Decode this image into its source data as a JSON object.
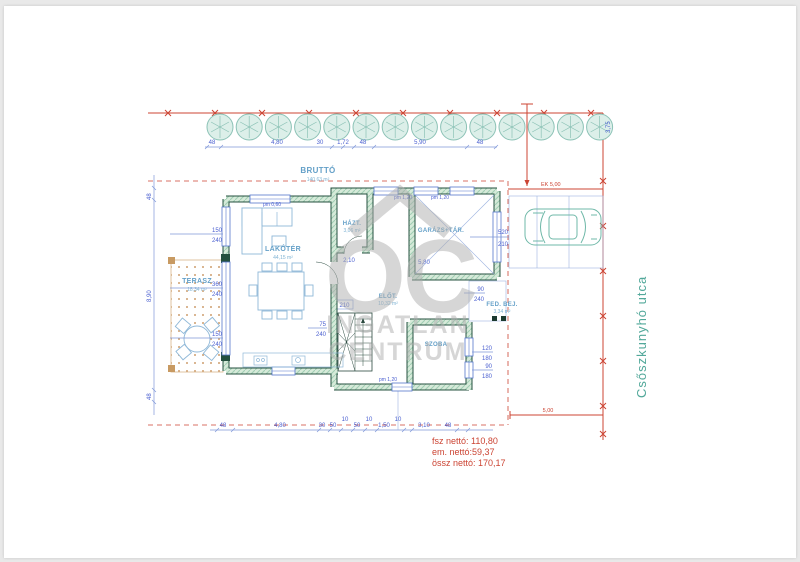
{
  "site": {
    "street": "Csőszkunyhó utca"
  },
  "watermark": {
    "monogram": "OC",
    "line1": "INGATLAN",
    "line2": "CENTRUM"
  },
  "summary": {
    "floor": "fsz nettó: 110,80",
    "upper": "em. nettó:59,37",
    "total": "össz nettó: 170,17"
  },
  "rooms": {
    "brutto": {
      "name": "BRUTTÓ",
      "area": "140,63 m²"
    },
    "lakoter": {
      "name": "LAKÓTÉR",
      "area": "44,15 m²"
    },
    "terasz": {
      "name": "TERASZ",
      "area": "18,34 m²"
    },
    "hazt": {
      "name": "HÁZT.",
      "area": "3,06 m²"
    },
    "garazs": {
      "name": "GARÁZS+TÁR."
    },
    "elot": {
      "name": "ELŐT.",
      "area": "10,32 m²"
    },
    "fedbej": {
      "name": "FED. BEJ.",
      "area": "3,34 m²"
    },
    "szoba": {
      "name": "SZOBA"
    }
  },
  "dims": {
    "top": [
      "48",
      "4,80",
      "30",
      "1,72",
      "48",
      "5,90",
      "48"
    ],
    "bottom": [
      "48",
      "4,80",
      "30",
      "50",
      "10",
      "50",
      "10",
      "1,50",
      "10",
      "3,10",
      "48"
    ],
    "left_total": "8,90",
    "left_tick": "48",
    "right_lot": "3,75",
    "ek": "EK 5,00",
    "front_setback": "5,00",
    "garage_span": "5,80",
    "hazt_span": "2,10",
    "stair_width": "210",
    "pm060": "pm 0,60",
    "pm120": "pm 1,20",
    "windows": {
      "w150_240": [
        "150",
        "240"
      ],
      "w360_240": [
        "360",
        "240"
      ],
      "w520_210": [
        "520",
        "210"
      ],
      "w120_180": [
        "120",
        "180"
      ],
      "w90_180": [
        "90",
        "180"
      ],
      "w75_240": [
        "75",
        "240"
      ],
      "w90_240": [
        "90",
        "240"
      ]
    }
  },
  "colors": {
    "boundary_red": "#cc4433",
    "dimension_blue": "#4a5fd0",
    "wall_green": "#24503f",
    "tree_teal": "#8cc2b6",
    "label_blue": "#64a0c8",
    "street_teal": "#52a89a"
  }
}
